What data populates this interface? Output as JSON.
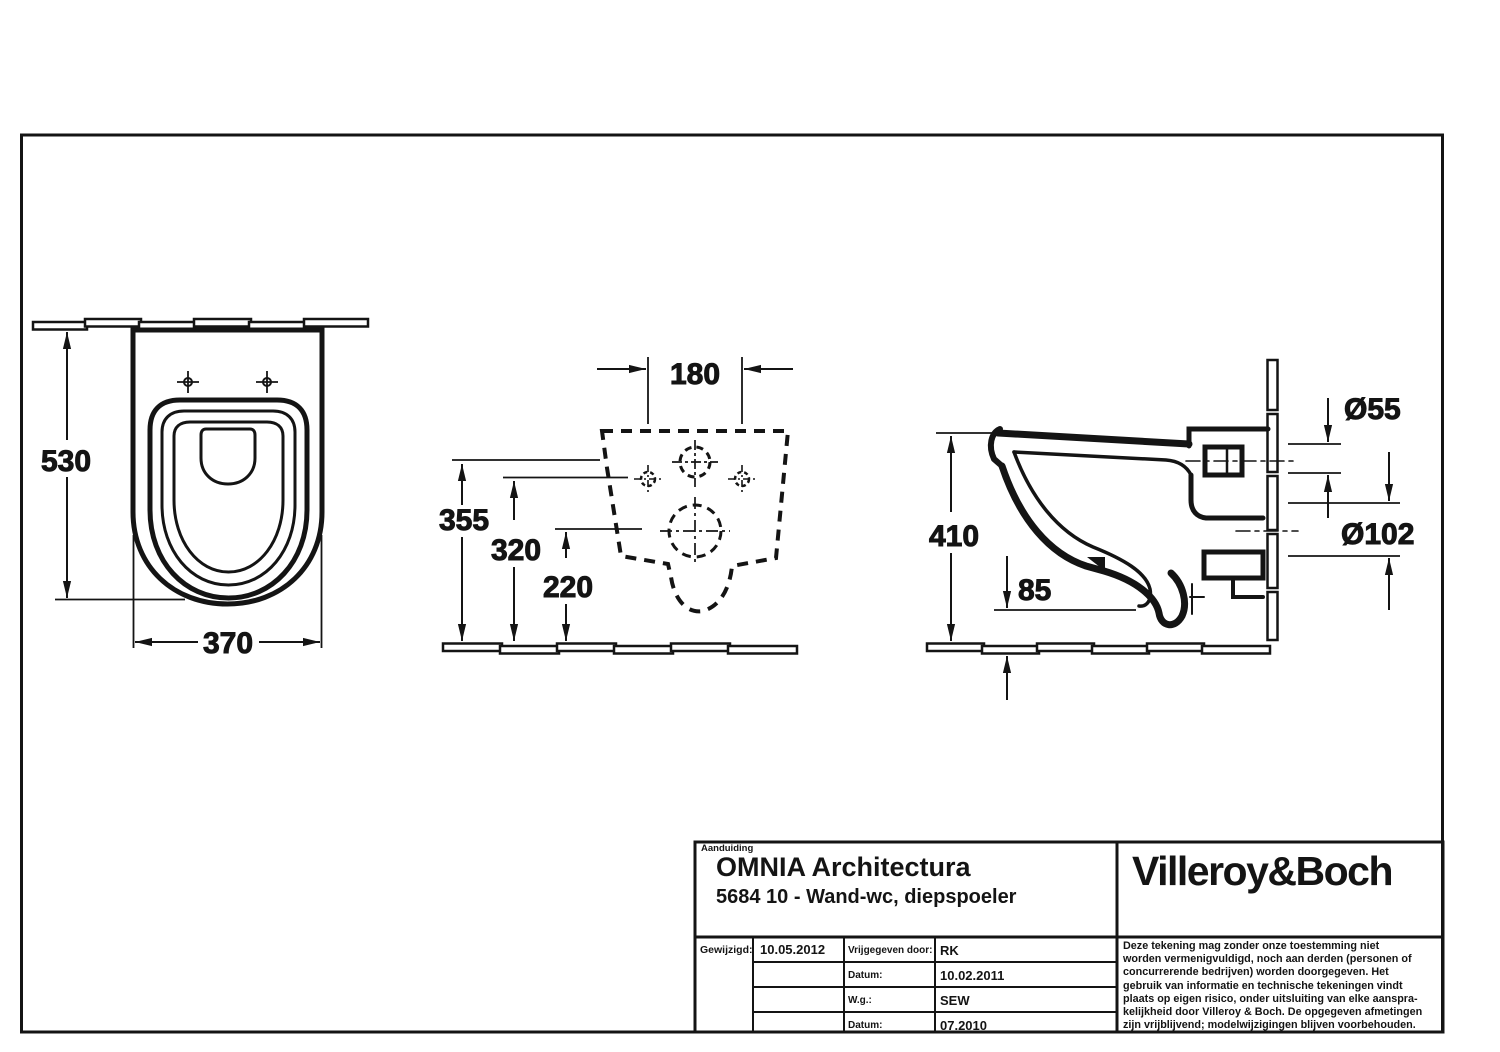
{
  "colors": {
    "line": "#141414",
    "background": "#ffffff"
  },
  "dimensions": {
    "top_view": {
      "depth": "530",
      "width": "370"
    },
    "rear_view": {
      "hole_spacing": "180",
      "inlet_height": "355",
      "mounting_holes_height": "320",
      "drain_height": "220"
    },
    "side_view": {
      "height": "410",
      "bottom_edge_height": "85",
      "flush_inlet_diameter": "Ø55",
      "drain_diameter": "Ø102"
    }
  },
  "title_block": {
    "designation_label": "Aanduiding",
    "product_name": "OMNIA Architectura",
    "product_code": "5684 10 - Wand-wc, diepspoeler",
    "brand": "Villeroy&Boch",
    "table": {
      "modified_label": "Gewijzigd:",
      "modified_date": "10.05.2012",
      "rows": [
        {
          "label": "Vrijgegeven door:",
          "value": "RK"
        },
        {
          "label": "Datum:",
          "value": "10.02.2011"
        },
        {
          "label": "W.g.:",
          "value": "SEW"
        },
        {
          "label": "Datum:",
          "value": "07.2010"
        }
      ]
    },
    "disclaimer_lines": [
      "Deze tekening mag zonder onze toestemming niet",
      "worden vermenigvuldigd, noch aan derden  (personen of",
      "concurrerende bedrijven) worden doorgegeven. Het",
      "gebruik van informatie en technische tekeningen  vindt",
      "plaats op eigen risico, onder uitsluiting van elke aanspra-",
      "kelijkheid door Villeroy & Boch. De opgegeven afmetingen",
      "zijn vrijblijvend; modelwijzigingen blijven voorbehouden."
    ]
  }
}
